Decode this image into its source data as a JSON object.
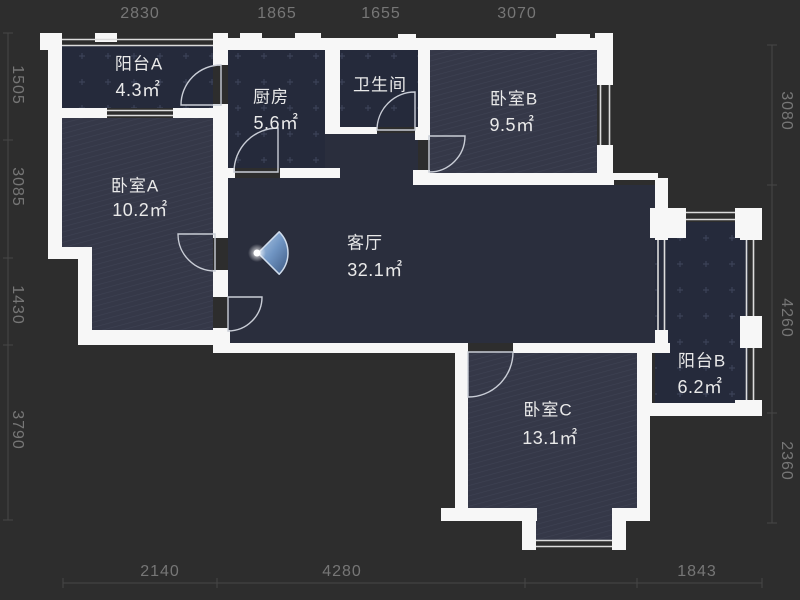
{
  "plan": {
    "title": "apartment-floor-plan",
    "rooms": [
      {
        "id": "balcony-a",
        "name": "阳台A",
        "area": "4.3㎡"
      },
      {
        "id": "kitchen",
        "name": "厨房",
        "area": "5.6㎡"
      },
      {
        "id": "bathroom",
        "name": "卫生间",
        "area": ""
      },
      {
        "id": "bedroom-b",
        "name": "卧室B",
        "area": "9.5㎡"
      },
      {
        "id": "bedroom-a",
        "name": "卧室A",
        "area": "10.2㎡"
      },
      {
        "id": "living-room",
        "name": "客厅",
        "area": "32.1㎡"
      },
      {
        "id": "balcony-b",
        "name": "阳台B",
        "area": "6.2㎡"
      },
      {
        "id": "bedroom-c",
        "name": "卧室C",
        "area": "13.1㎡"
      }
    ],
    "dimensions": {
      "top": [
        "2830",
        "1865",
        "1655",
        "3070"
      ],
      "bottom": [
        "2140",
        "4280",
        "1843"
      ],
      "left": [
        "1505",
        "3085",
        "1430",
        "3790"
      ],
      "right": [
        "3080",
        "4260",
        "2360"
      ]
    },
    "icons": {
      "viewpoint": "camera-viewpoint-cone"
    },
    "colors": {
      "background": "#2d2d2d",
      "wall": "#f7f7f7",
      "room_tiled": "#252a3b",
      "room_hatched": "#353848",
      "room_plain": "#2a2e3d",
      "label_text": "#e9e9e9",
      "dimension_text": "#767676",
      "viewpoint_cone": "#7fa8d9"
    }
  }
}
